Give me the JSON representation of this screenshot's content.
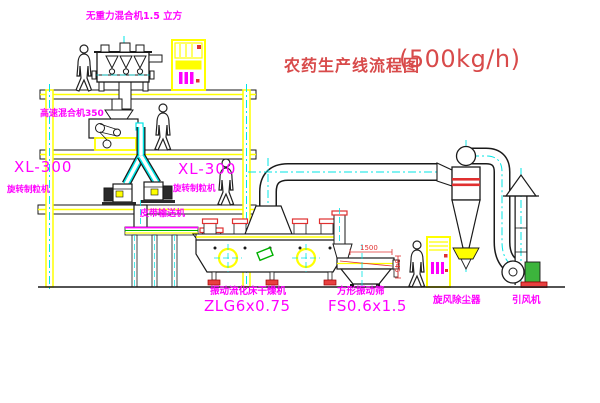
{
  "title": {
    "name": "农药生产线流程图",
    "capacity": "(500kg/h)"
  },
  "equipment_labels": {
    "gravity_mixer": "无重力混合机1.5 立方",
    "high_speed_mixer": "高速混合机350",
    "granulator_left_model": "XL-300",
    "granulator_left_name": "旋转制粒机",
    "granulator_right_model": "XL-300",
    "granulator_right_name": "旋转制粒机",
    "belt_conveyor": "皮带输送机",
    "dryer_name": "振动流化床干燥机",
    "dryer_model": "ZLG6x0.75",
    "sieve_name": "方形振动筛",
    "sieve_model": "FS0.6x1.5",
    "cyclone": "旋风除尘器",
    "fan": "引风机"
  },
  "dimensions": {
    "sieve_length": "1500",
    "sieve_height": "345"
  },
  "colors": {
    "label_magenta": "#ff00ff",
    "title_red": "#d84a4a",
    "dimension_red": "#e03030",
    "structure_yellow": "#ffff00",
    "centerline_cyan": "#00e5e5",
    "belt_green": "#00b000",
    "motor_green": "#3cb43c",
    "line_black": "#1a1a1a",
    "background": "#ffffff"
  }
}
